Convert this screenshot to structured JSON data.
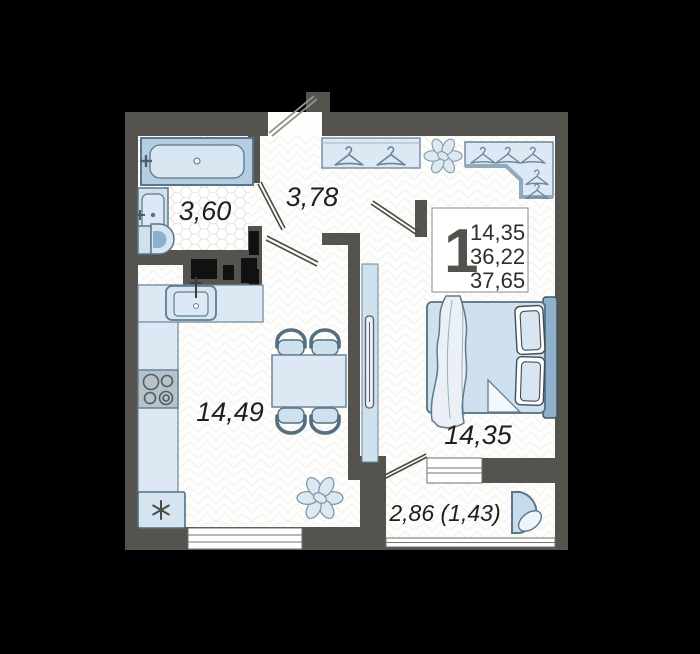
{
  "floorplan": {
    "info": {
      "rooms": "1",
      "line1": "14,35",
      "line2": "36,22",
      "line3": "37,65"
    },
    "labels": {
      "bathroom": "3,60",
      "hallway": "3,78",
      "kitchen_living": "14,49",
      "bedroom": "14,35",
      "balcony": "2,86 (1,43)"
    },
    "symbols": {
      "fridge_icon": "six-spoke-snowflake-asterisk",
      "hanger_icon": "clothes-hanger",
      "plant_icon": "potted-plant-top-view"
    },
    "colors": {
      "background": "#000000",
      "wall": "#55534d",
      "floor": "#fdfdfc",
      "furniture_fill": "#d7e5f1",
      "furniture_stroke": "#5a7589",
      "headboard": "#8fb0c9",
      "duct": "#111111"
    }
  }
}
